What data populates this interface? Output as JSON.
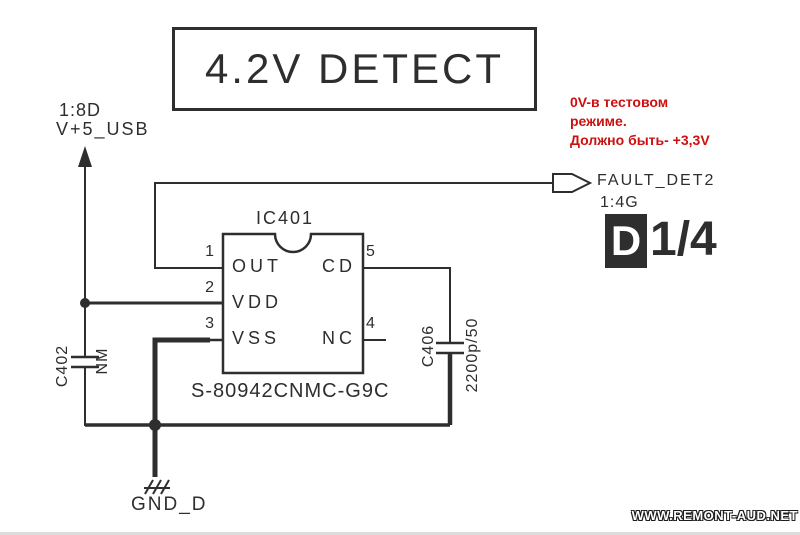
{
  "colors": {
    "line": "#2e2e2e",
    "note_red": "#cc1010",
    "sheet_box_bg": "#2e2e2e",
    "background": "#ffffff"
  },
  "title": "4.2V DETECT",
  "power_input": {
    "sheet_ref": "1:8D",
    "net": "V+5_USB"
  },
  "note": {
    "lines": [
      "0V-в тестовом",
      "режиме.",
      "Должно быть- +3,3V"
    ]
  },
  "ic": {
    "designator": "IC401",
    "part_number": "S-80942CNMC-G9C",
    "pins": {
      "p1": {
        "num": "1",
        "label": "OUT"
      },
      "p2": {
        "num": "2",
        "label": "VDD"
      },
      "p3": {
        "num": "3",
        "label": "VSS"
      },
      "p4": {
        "num": "4",
        "label": "NC"
      },
      "p5": {
        "num": "5",
        "label": "CD"
      }
    }
  },
  "capacitors": {
    "c402": {
      "ref": "C402",
      "value": "NM"
    },
    "c406": {
      "ref": "C406",
      "value": "2200p/50"
    }
  },
  "output": {
    "net": "FAULT_DET2",
    "sheet_ref": "1:4G",
    "sheet_letter": "D",
    "sheet_ratio": "1/4"
  },
  "ground": {
    "net": "GND_D"
  },
  "watermark": "WWW.REMONT-AUD.NET"
}
